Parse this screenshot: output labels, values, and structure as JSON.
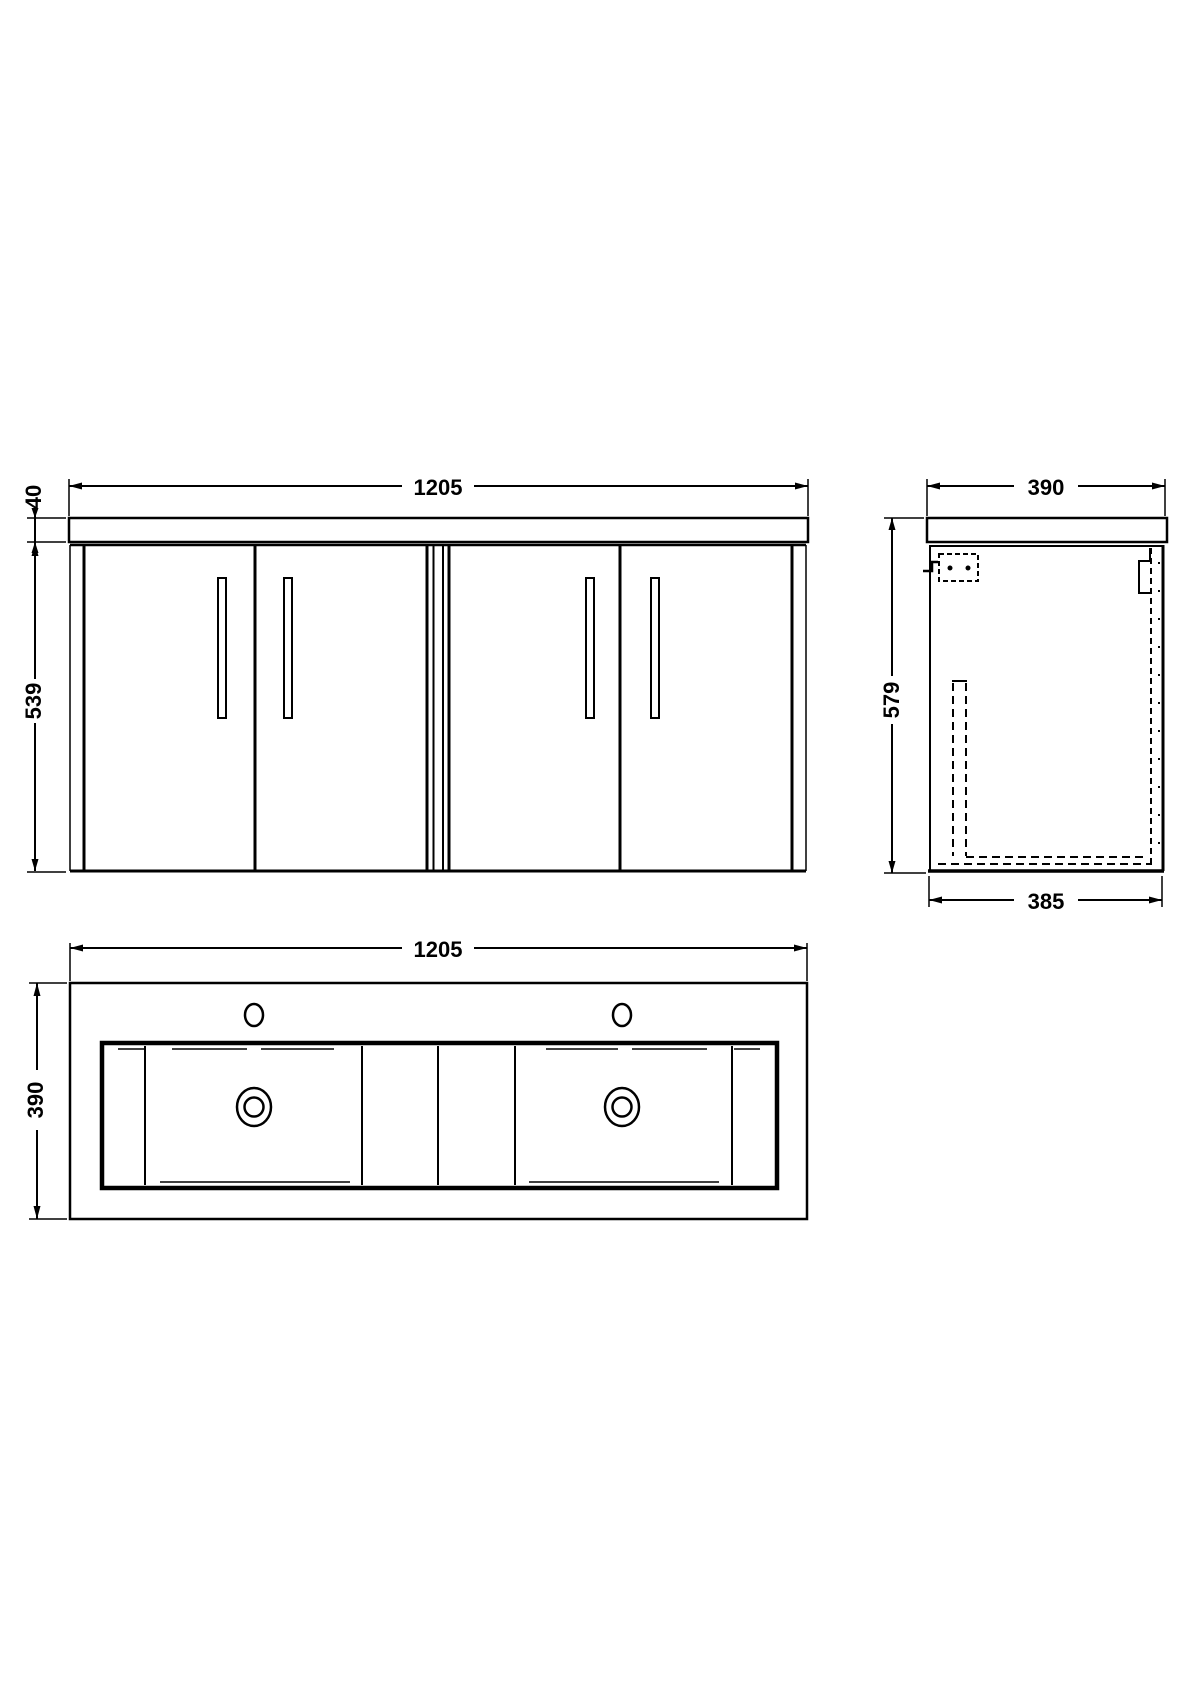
{
  "colors": {
    "line": "#000000",
    "background": "#ffffff"
  },
  "views": {
    "front": {
      "width_label": "1205",
      "worktop_thickness_label": "40",
      "cabinet_height_label": "539"
    },
    "side": {
      "depth_label": "390",
      "overall_height_label": "579",
      "cabinet_depth_label": "385"
    },
    "plan": {
      "width_label": "1205",
      "depth_label": "390"
    }
  }
}
